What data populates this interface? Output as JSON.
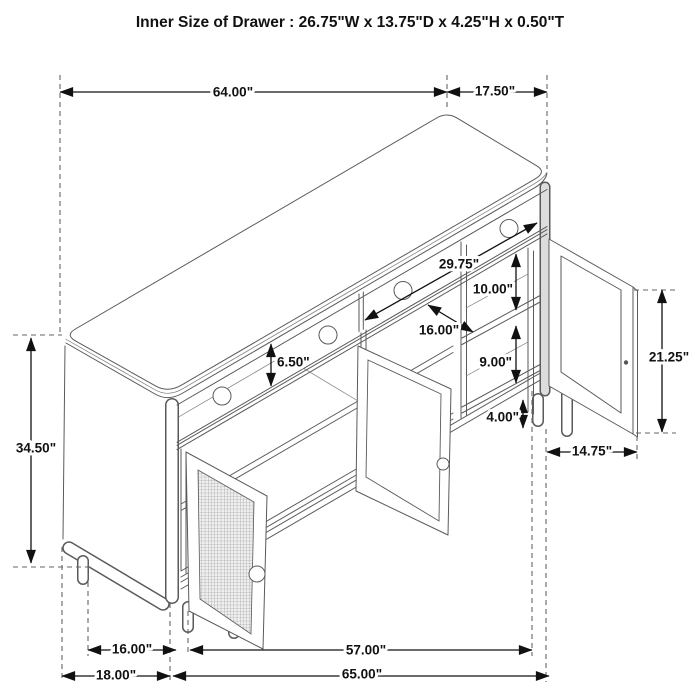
{
  "title": "Inner Size of Drawer  : 26.75\"W x 13.75\"D x 4.25\"H x 0.50\"T",
  "dims": {
    "top_width": "64.00\"",
    "top_depth": "17.50\"",
    "overall_height": "34.50\"",
    "drawer_face_height": "6.50\"",
    "inner_width": "29.75\"",
    "upper_shelf_clearance": "10.00\"",
    "shelf_depth": "16.00\"",
    "lower_shelf_clearance": "9.00\"",
    "leg_clearance": "4.00\"",
    "door_height": "21.25\"",
    "door_width": "14.75\"",
    "base_depth_inner": "16.00\"",
    "base_width_inner": "57.00\"",
    "base_depth_overall": "18.00\"",
    "base_width_overall": "65.00\""
  }
}
